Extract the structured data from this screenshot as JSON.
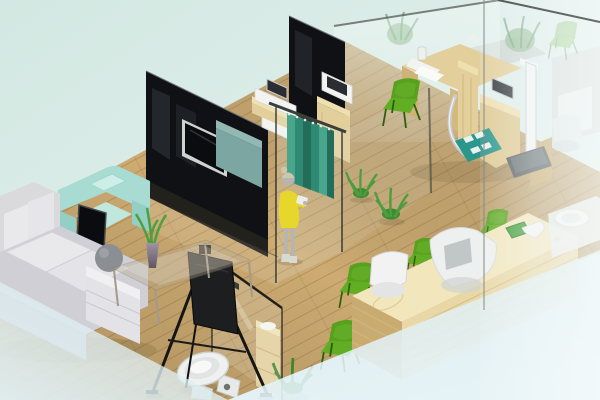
{
  "scene": {
    "type": "3d-isometric-interior-render",
    "description": "Isometric 3D render of a clinic/office interior: wood plank floor, black glass partition walls, teal privacy curtain with a woman in a yellow dress, lounge with corner sofa and mint armchair, glass coffee table with aloe vase, easel display board, restroom with glass door and toilet, wooden examination desks with devices and height scale, long wooden reception counter with white staff chairs and green visitor chairs, frosted glass wall on the right",
    "objects": [
      {
        "name": "wood-floor",
        "label": "wood plank floor"
      },
      {
        "name": "black-partition-walls",
        "label": "black glass partition walls"
      },
      {
        "name": "wall-tv",
        "label": "wall-mounted TV"
      },
      {
        "name": "privacy-curtain",
        "label": "teal privacy curtain"
      },
      {
        "name": "woman-yellow-dress",
        "label": "standing woman in yellow dress"
      },
      {
        "name": "corner-sofa",
        "label": "gray corner sofa"
      },
      {
        "name": "mint-armchair",
        "label": "mint armchair"
      },
      {
        "name": "floor-tv-stand",
        "label": "TV on floor stand"
      },
      {
        "name": "easel-board",
        "label": "black easel display board"
      },
      {
        "name": "coffee-table",
        "label": "glass coffee table with aloe vase"
      },
      {
        "name": "restroom",
        "label": "restroom with glass door, shelf and toilet"
      },
      {
        "name": "exam-desks",
        "label": "wooden exam desks with devices"
      },
      {
        "name": "height-scale",
        "label": "height measuring scale"
      },
      {
        "name": "green-mat",
        "label": "green mat with white pads"
      },
      {
        "name": "reception-counter",
        "label": "wooden reception counter"
      },
      {
        "name": "staff-chairs",
        "label": "white staff chairs"
      },
      {
        "name": "visitor-chairs",
        "label": "green visitor chairs"
      },
      {
        "name": "wash-basin",
        "label": "wash basin"
      },
      {
        "name": "indoor-plants",
        "label": "potted green plants"
      },
      {
        "name": "frosted-glass-wall",
        "label": "frosted glass wall"
      }
    ]
  },
  "palette": {
    "bg_top": "#d4e8e3",
    "bg_pale": "#e2f0f4",
    "frost": "#f6fbfb",
    "floor": "#cdab72",
    "black_glass": "#101114",
    "screen": "#0a0c0f",
    "glass_edge": "#2b2d28",
    "curtain": "#2f8a74",
    "curtain_dark": "#236e5a",
    "curtain_light": "#49a68c",
    "teal_cabinet": "#7ba6a1",
    "pine": "#e3cf9b",
    "pine_dark": "#c9ab6f",
    "counter": "#e9d8a6",
    "counter_top": "#f2e6bd",
    "sofa": "#cfcfd5",
    "sofa_cushion": "#e9e9ec",
    "armchair": "#a8dcd2",
    "chair_green": "#57a11d",
    "chair_green_seat": "#61ad24",
    "device_white": "#f3f4f2",
    "mat": "#2b968c",
    "plant": "#3f8a33",
    "skin": "#b7b5ad",
    "hair": "#cfc6ad",
    "dress": "#e7d62b",
    "toilet": "#eff1f0",
    "chrome": "#c6cbce",
    "easel_board": "#1c1e20",
    "scale_base": "#585e60"
  }
}
